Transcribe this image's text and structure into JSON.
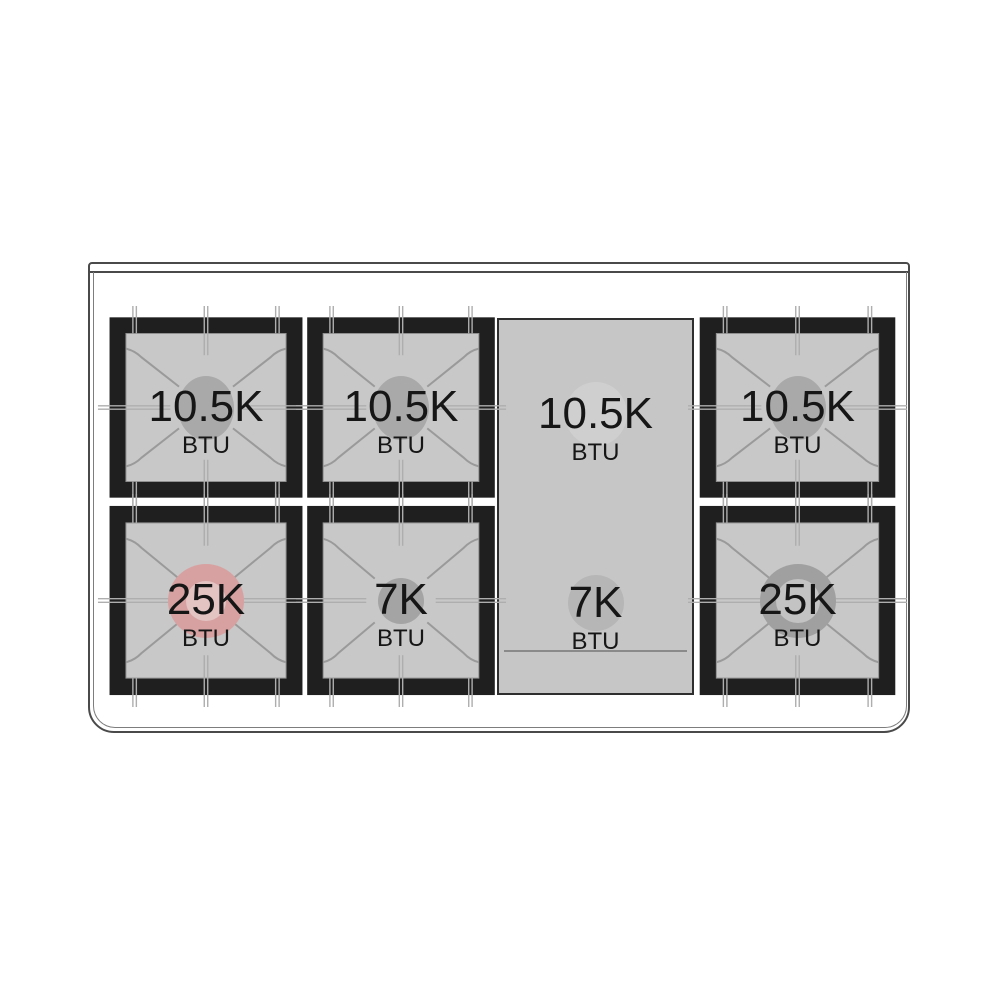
{
  "diagram": {
    "title": "gas-range-cooktop-burner-layout",
    "burners": [
      {
        "id": "rear-left",
        "row": "rear",
        "position": "left",
        "value": "10.5K",
        "unit": "BTU",
        "cap_style": "standard"
      },
      {
        "id": "rear-center",
        "row": "rear",
        "position": "center-left",
        "value": "10.5K",
        "unit": "BTU",
        "cap_style": "standard"
      },
      {
        "id": "rear-right",
        "row": "rear",
        "position": "right",
        "value": "10.5K",
        "unit": "BTU",
        "cap_style": "standard"
      },
      {
        "id": "front-left",
        "row": "front",
        "position": "left",
        "value": "25K",
        "unit": "BTU",
        "cap_style": "dual-ring-highlighted"
      },
      {
        "id": "front-center",
        "row": "front",
        "position": "center-left",
        "value": "7K",
        "unit": "BTU",
        "cap_style": "small"
      },
      {
        "id": "front-right",
        "row": "front",
        "position": "right",
        "value": "25K",
        "unit": "BTU",
        "cap_style": "dual-ring"
      }
    ],
    "griddle": {
      "rear": {
        "value": "10.5K",
        "unit": "BTU"
      },
      "front": {
        "value": "7K",
        "unit": "BTU"
      }
    },
    "colors": {
      "grate_black": "#1f1f1f",
      "surface_gray": "#c8c8c8",
      "griddle_gray": "#c6c6c6",
      "burner_cap_gray": "#a9a9a9",
      "highlight_pink": "#d7a1a1",
      "highlight_pink_inner": "#e4c3c3",
      "grate_line_gray": "#aeaeae",
      "body_outline": "#4a4a4a",
      "text": "#161616",
      "background": "#ffffff"
    }
  }
}
